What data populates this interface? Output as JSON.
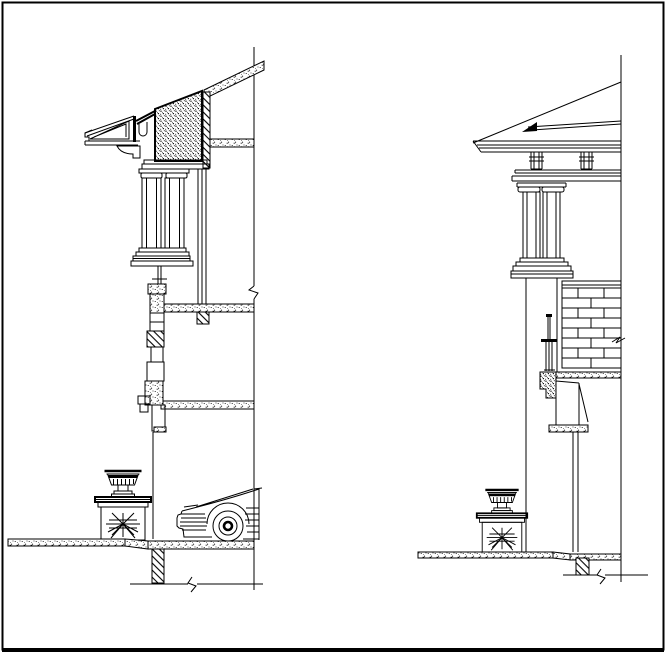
{
  "canvas": {
    "width": 666,
    "height": 654,
    "background_color": "#ffffff",
    "line_color": "#000000",
    "border_color": "#000000"
  },
  "drawing": {
    "type": "architectural_cad_line_drawing",
    "text_labels": [],
    "views": [
      {
        "id": "left-view",
        "name": "eave-and-wall-section-detail",
        "components": [
          "pitched-roof-slab",
          "cornice-with-gutter",
          "stippled-attic-panel",
          "architrave-band",
          "paired-pilasters",
          "window-frame",
          "ceiling-slab",
          "floor-slabs",
          "wall-section-stack",
          "foundation-wall",
          "ground-slab",
          "pedestal-with-urn",
          "starburst-ornament",
          "car-silhouette",
          "break-marks"
        ]
      },
      {
        "id": "right-view",
        "name": "porch-column-and-eave-elevation-detail",
        "components": [
          "hip-roof-slope",
          "fascia-band",
          "eave-brackets",
          "entablature",
          "paired-columns",
          "column-pier",
          "brick-wall-panel",
          "railing-post-section",
          "window-sill-section",
          "floor-slab",
          "foundation-wall",
          "ground-slab",
          "pedestal-with-urn",
          "starburst-ornament",
          "break-marks"
        ]
      }
    ]
  }
}
